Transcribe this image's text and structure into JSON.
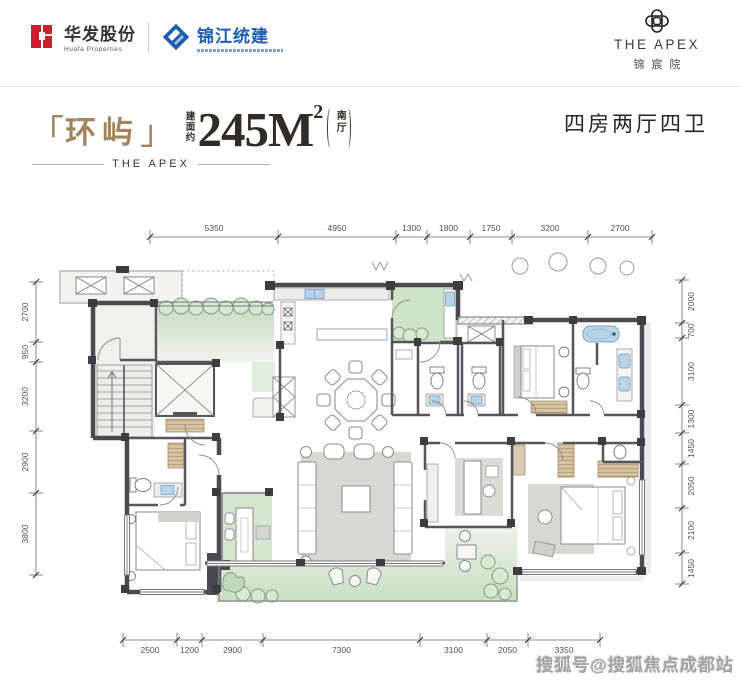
{
  "header": {
    "huafa": {
      "cn": "华发股份",
      "en": "Huafa Properties"
    },
    "jinjiang": {
      "cn": "锦江统建"
    },
    "apex": {
      "en": "THE APEX",
      "cn": "锦宸院"
    }
  },
  "title": {
    "bracket_open": "「",
    "name": "环屿",
    "bracket_close": "」",
    "area_label": "建面约",
    "area_value": "245M",
    "area_sup": "2",
    "area_tag": "南厅",
    "brand_line": "THE APEX",
    "layout_spec": "四房两厅四卫"
  },
  "floorplan": {
    "dims_top": [
      "5350",
      "4950",
      "1300",
      "1800",
      "1750",
      "3200",
      "2700"
    ],
    "dims_bottom": [
      "2500",
      "1200",
      "2900",
      "7300",
      "3100",
      "2050",
      "3350"
    ],
    "dims_left": [
      "2700",
      "950",
      "3200",
      "2900",
      "3800"
    ],
    "dims_right": [
      "2000",
      "700",
      "3100",
      "1300",
      "1450",
      "2050",
      "2100",
      "1450"
    ]
  },
  "watermark": "搜狐号@搜狐焦点成都站",
  "colors": {
    "accent_gold": "#a1845e",
    "logo_red": "#c7202f",
    "logo_blue": "#1d5dab",
    "garden_green": "#cfe2c8",
    "water_blue": "#b9d4e8",
    "wall_dark": "#4a4a4f"
  }
}
